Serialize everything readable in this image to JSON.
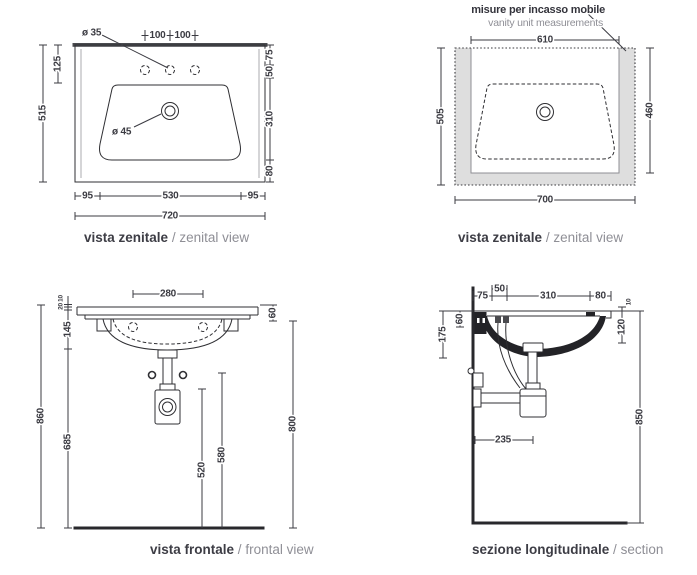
{
  "drawing_type": "washbasin technical drawing",
  "colors": {
    "line": "#2f2f33",
    "dim_text": "#3b3b42",
    "muted_text": "#8f8f96",
    "vanity_fill": "#dedede",
    "section_fill": "#232327",
    "top_edge_strip": "#4a4b4f",
    "background": "#ffffff"
  },
  "views": {
    "zenital_left": {
      "caption_it": "vista zenitale",
      "caption_sep": "/",
      "caption_en": "zenital view",
      "dims": {
        "hole_diameter": "ø 35",
        "tap_left": "100",
        "tap_right": "100",
        "left_125": "125",
        "left_515": "515",
        "right_75": "75",
        "right_50": "50",
        "right_310": "310",
        "right_80": "80",
        "bottom_95l": "95",
        "bottom_530": "530",
        "bottom_95r": "95",
        "bottom_720": "720",
        "drain_diameter": "ø 45"
      }
    },
    "zenital_right": {
      "caption_it": "vista zenitale",
      "caption_sep": "/",
      "caption_en": "zenital view",
      "note_it": "misure per incasso mobile",
      "note_en": "vanity unit measurements",
      "dims": {
        "top_610": "610",
        "left_505": "505",
        "right_460": "460",
        "bottom_700": "700"
      }
    },
    "frontal": {
      "caption_it": "vista frontale",
      "caption_sep": "/",
      "caption_en": "frontal view",
      "dims": {
        "top_280": "280",
        "small_10": "10",
        "small_20": "20",
        "left_145": "145",
        "left_685": "685",
        "left_860": "860",
        "mid_520": "520",
        "mid_580": "580",
        "right_60": "60",
        "right_800": "800"
      }
    },
    "section": {
      "caption_it": "sezione longitudinale",
      "caption_sep": "/",
      "caption_en": "section",
      "dims": {
        "top_75": "75",
        "top_50": "50",
        "top_310": "310",
        "top_80": "80",
        "left_60": "60",
        "left_175": "175",
        "right_10": "10",
        "right_120": "120",
        "right_850": "850",
        "mid_235": "235"
      }
    }
  }
}
